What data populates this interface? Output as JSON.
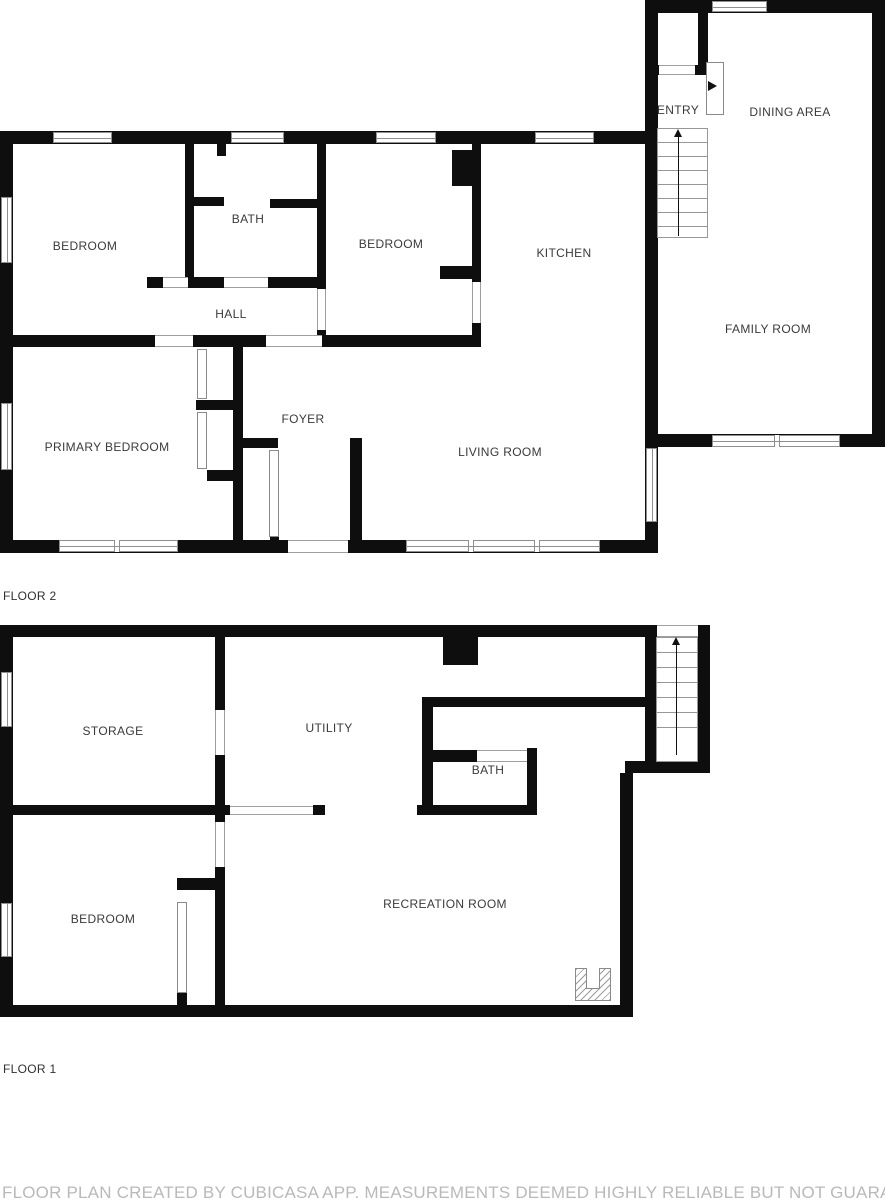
{
  "floor2": {
    "label": "FLOOR 2",
    "rooms": {
      "bedroom1": "BEDROOM",
      "bath": "BATH",
      "bedroom2": "BEDROOM",
      "kitchen": "KITCHEN",
      "entry": "ENTRY",
      "dining": "DINING AREA",
      "family": "FAMILY ROOM",
      "hall": "HALL",
      "primary": "PRIMARY BEDROOM",
      "foyer": "FOYER",
      "living": "LIVING ROOM"
    }
  },
  "floor1": {
    "label": "FLOOR 1",
    "rooms": {
      "storage": "STORAGE",
      "utility": "UTILITY",
      "bath": "BATH",
      "bedroom": "BEDROOM",
      "recreation": "RECREATION ROOM"
    }
  },
  "footer": {
    "disclaimer": "FLOOR PLAN CREATED BY CUBICASA APP. MEASUREMENTS DEEMED HIGHLY RELIABLE BUT NOT GUARANTEED."
  },
  "icons": {
    "stairs_up_arrow": "▲",
    "entry_door_arrow": "▶"
  },
  "colors": {
    "wall": "#0e0e0e",
    "room_label": "#3a3a3a",
    "frame_gray": "#8f8f8f",
    "footer_text": "#b9b9b9"
  }
}
